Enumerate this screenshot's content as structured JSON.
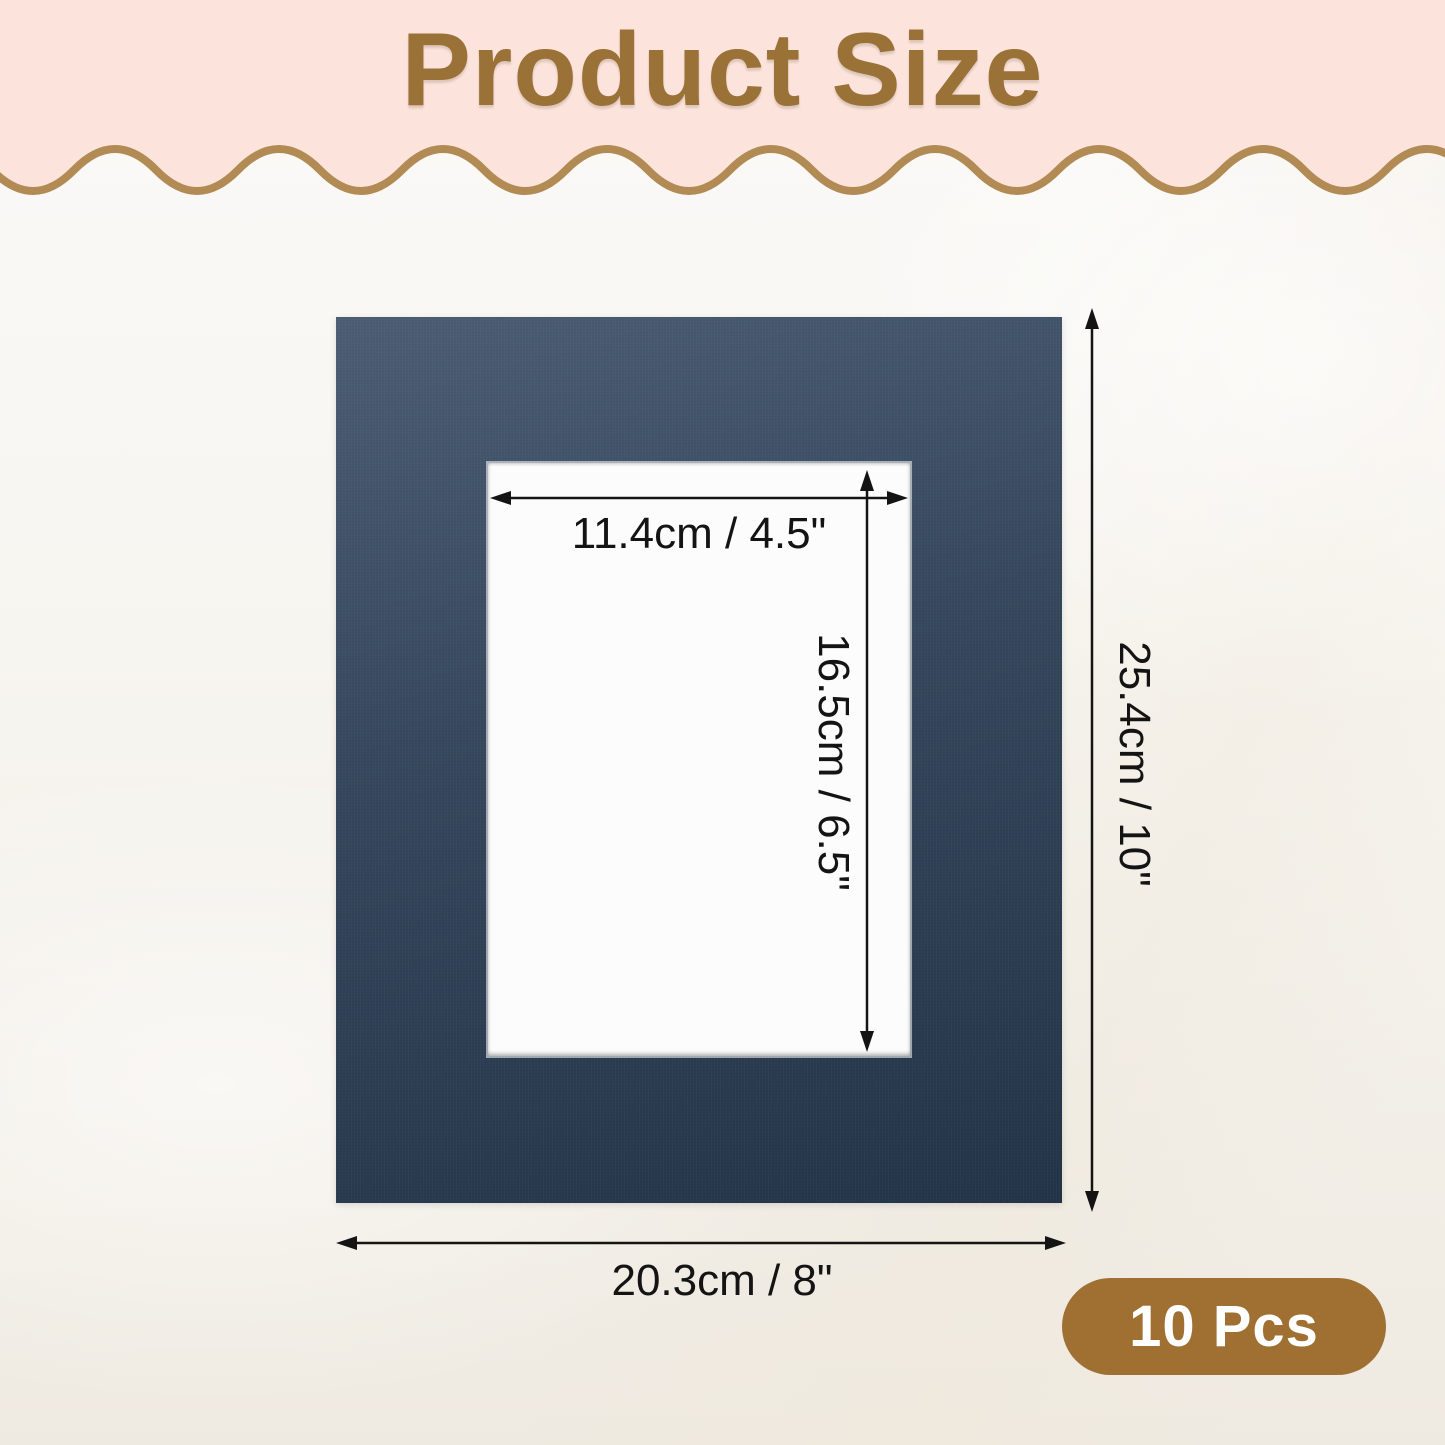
{
  "header": {
    "title": "Product Size"
  },
  "dimensions": {
    "opening_width_label": "11.4cm / 4.5\"",
    "opening_height_label": "16.5cm / 6.5\"",
    "mat_height_label": "25.4cm / 10\"",
    "mat_width_label": "20.3cm / 8\""
  },
  "badge": {
    "label": "10 Pcs"
  },
  "colors": {
    "header_pink": "#FCE4DC",
    "title_brown": "#9A7137",
    "wave_brown": "#B18A54",
    "badge_brown": "#9F7031",
    "badge_text": "#FFFFFF",
    "mat_navy_top": "#4C5E74",
    "mat_navy_mid": "#36485D",
    "mat_navy_bottom": "#233448",
    "opening_white": "#FCFCFC",
    "dimension_ink": "#141414",
    "bg_top": "#FBFAF8",
    "bg_mid": "#F7F5F0",
    "bg_bottom": "#EFEAE1"
  }
}
